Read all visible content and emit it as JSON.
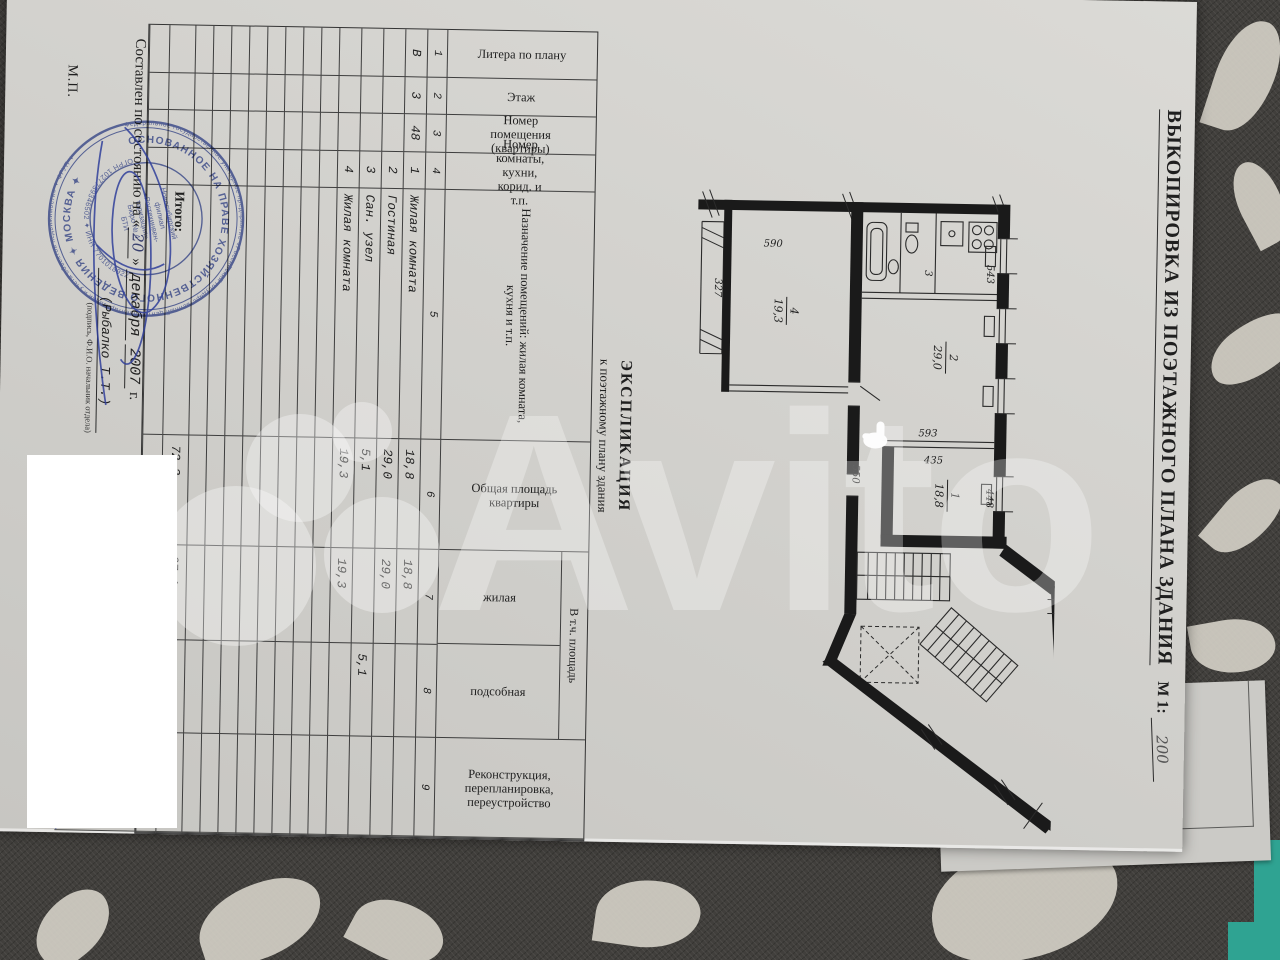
{
  "watermark": {
    "brand": "Avito"
  },
  "page": {
    "title": "ВЫКОПИРОВКА ИЗ ПОЭТАЖНОГО ПЛАНА ЗДАНИЯ",
    "scale_label": "М 1:",
    "scale_value": "200"
  },
  "plan": {
    "dims": {
      "d590": "590",
      "d327": "327",
      "d550": "550",
      "d543": "543",
      "d593": "593",
      "d435": "435",
      "d448": "448"
    },
    "rooms": [
      {
        "num": "4",
        "area": "19,3"
      },
      {
        "num": "2",
        "area": "29,0"
      },
      {
        "num": "1",
        "area": "18,8"
      },
      {
        "num": "3",
        "area": "3"
      }
    ]
  },
  "explication": {
    "heading": "ЭКСПЛИКАЦИЯ",
    "subheading": "к поэтажному плану здания",
    "columns": [
      "Литера по плану",
      "Этаж",
      "Номер помещения (квартиры)",
      "Номер комнаты, кухни, корид. и т.п.",
      "Назначение помещений: жилая комната, кухня и т.п.",
      "Общая площадь квартиры",
      "жилая",
      "подсобная",
      "Реконструкция, перепланировка, переустройство"
    ],
    "group_header": "В т.ч. площадь",
    "col_numbers": [
      "1",
      "2",
      "3",
      "4",
      "5",
      "6",
      "7",
      "8",
      "9"
    ],
    "rows": [
      {
        "litera": "В",
        "etazh": "3",
        "apt": "48",
        "room": "1",
        "name": "Жилая комната",
        "total": "18,8",
        "living": "18,8",
        "aux": ""
      },
      {
        "litera": "",
        "etazh": "",
        "apt": "",
        "room": "2",
        "name": "Гостиная",
        "total": "29,0",
        "living": "29,0",
        "aux": ""
      },
      {
        "litera": "",
        "etazh": "",
        "apt": "",
        "room": "3",
        "name": "Сан. узел",
        "total": "5,1",
        "living": "",
        "aux": "5,1"
      },
      {
        "litera": "",
        "etazh": "",
        "apt": "",
        "room": "4",
        "name": "Жилая комната",
        "total": "19,3",
        "living": "19,3",
        "aux": ""
      }
    ],
    "totals": {
      "label": "Итого:",
      "total": "72,2",
      "living": "67,1",
      "aux": "5,1"
    }
  },
  "footer": {
    "compiled_prefix": "Составлен по состоянию на «",
    "compiled_day": "20",
    "compiled_mid": "» ",
    "compiled_month": "декабря",
    "compiled_year": "2007",
    "compiled_end": " г.",
    "name": "(Рыбалко Т.Т.)",
    "caption": "(подпись, Ф.И.О. начальник отдела)",
    "mp": "М.П."
  },
  "stamp": {
    "ring_outer": "Федеральное государственное унитарное предприятие «Российский государственный центр инвентаризации и учета объектов недвижимости» ✦ ФГУП ✦",
    "ring_inner": "ОСНОВАННОЕ НА ПРАВЕ ХОЗЯЙСТВЕННОГО ВЕДЕНИЯ ✦ МОСКВА ✦",
    "ring_bottom": "ОГРН 1027739346502 ✦ ИНН 7701018922",
    "center": [
      "Новосибирский",
      "филиал",
      "«Ростехинвен-",
      "таризация»",
      "Бюро № 4",
      "БТИ"
    ]
  }
}
